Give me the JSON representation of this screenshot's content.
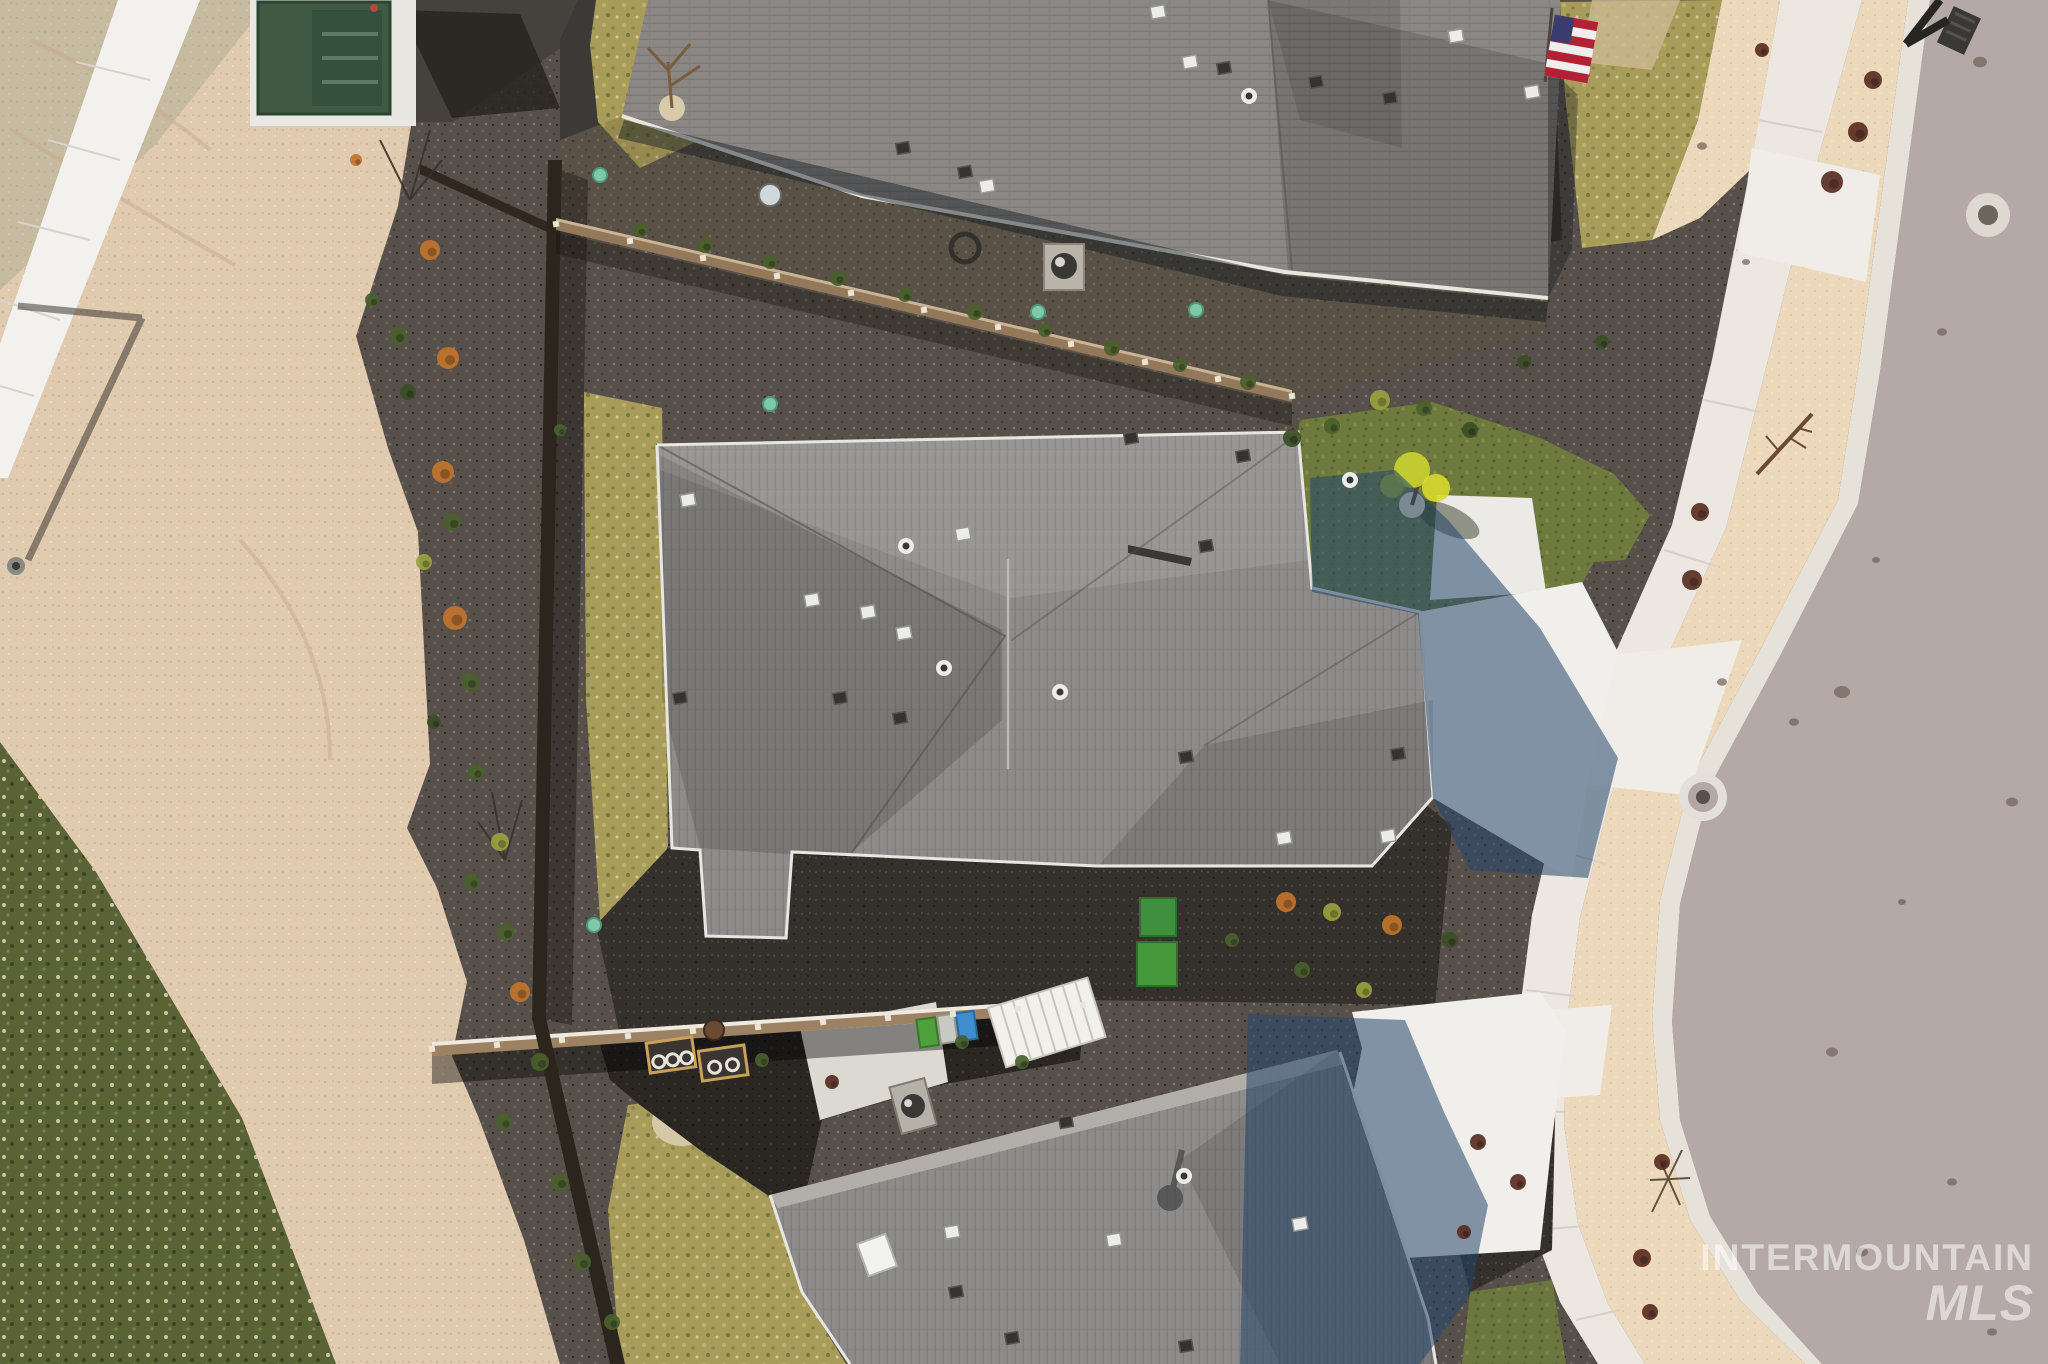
{
  "watermark": {
    "line1": "INTERMOUNTAIN",
    "line2": "MLS"
  },
  "palette": {
    "sand": "#e0cab0",
    "sandBright": "#ecd8ba",
    "road": "#b4a9a7",
    "curb": "#e6e1d9",
    "concrete": "#ece8e1",
    "concreteBright": "#f1efeb",
    "gravel": "#57504a",
    "gravelDark": "#34302b",
    "mulchDark": "#2a2723",
    "roofMid": "#8e8c8a",
    "roofTop": "#8a8784",
    "roofLight": "#b6b3ae",
    "drylawn": "#a89c5a",
    "greenlawn": "#6e7a3e",
    "weeds": "#5a6336",
    "fenceTan": "#93785a",
    "fenceDark": "#2c251e",
    "shadowBlue": "#24456b",
    "boxGreen": "#415a44",
    "binGreen": "#4da03c",
    "binBlue": "#3e8ed0",
    "binGray": "#c9c9c3",
    "flagRed": "#b22234",
    "flagBlue": "#3c3b6e",
    "teal": "#7fc9a8",
    "shrubOrange": "#c1742c",
    "shrubGreen": "#4a5f2d",
    "shrubYellow": "#97a33e",
    "shrubDark": "#3c4d26",
    "shrubRed": "#5a2e22",
    "white": "#f2f1ed"
  },
  "sprites": [
    {
      "k": "shrub",
      "x": 430,
      "y": 250,
      "r": 10,
      "c": "shrubOrange"
    },
    {
      "k": "shrub",
      "x": 398,
      "y": 336,
      "r": 9,
      "c": "shrubGreen"
    },
    {
      "k": "shrub",
      "x": 448,
      "y": 358,
      "r": 11,
      "c": "shrubOrange"
    },
    {
      "k": "shrub",
      "x": 372,
      "y": 300,
      "r": 7,
      "c": "shrubGreen"
    },
    {
      "k": "shrub",
      "x": 443,
      "y": 472,
      "r": 11,
      "c": "shrubOrange"
    },
    {
      "k": "shrub",
      "x": 408,
      "y": 392,
      "r": 8,
      "c": "shrubDark"
    },
    {
      "k": "shrub",
      "x": 452,
      "y": 522,
      "r": 9,
      "c": "shrubGreen"
    },
    {
      "k": "shrub",
      "x": 424,
      "y": 562,
      "r": 8,
      "c": "shrubYellow"
    },
    {
      "k": "shrub",
      "x": 455,
      "y": 618,
      "r": 12,
      "c": "shrubOrange"
    },
    {
      "k": "shrub",
      "x": 470,
      "y": 682,
      "r": 9,
      "c": "shrubGreen"
    },
    {
      "k": "shrub",
      "x": 434,
      "y": 722,
      "r": 7,
      "c": "shrubDark"
    },
    {
      "k": "shrub",
      "x": 476,
      "y": 772,
      "r": 8,
      "c": "shrubGreen"
    },
    {
      "k": "shrub",
      "x": 500,
      "y": 842,
      "r": 9,
      "c": "shrubYellow"
    },
    {
      "k": "shrub",
      "x": 472,
      "y": 882,
      "r": 8,
      "c": "shrubGreen"
    },
    {
      "k": "shrub",
      "x": 506,
      "y": 932,
      "r": 9,
      "c": "shrubGreen"
    },
    {
      "k": "shrub",
      "x": 520,
      "y": 992,
      "r": 10,
      "c": "shrubOrange"
    },
    {
      "k": "shrub",
      "x": 540,
      "y": 1062,
      "r": 9,
      "c": "shrubGreen"
    },
    {
      "k": "shrub",
      "x": 504,
      "y": 1122,
      "r": 8,
      "c": "shrubGreen"
    },
    {
      "k": "shrub",
      "x": 560,
      "y": 1182,
      "r": 9,
      "c": "shrubGreen"
    },
    {
      "k": "shrub",
      "x": 582,
      "y": 1262,
      "r": 9,
      "c": "shrubGreen"
    },
    {
      "k": "shrub",
      "x": 612,
      "y": 1322,
      "r": 8,
      "c": "shrubGreen"
    },
    {
      "k": "shrub",
      "x": 356,
      "y": 160,
      "r": 6,
      "c": "shrubOrange"
    },
    {
      "k": "shrub",
      "x": 640,
      "y": 230,
      "r": 7,
      "c": "shrubGreen"
    },
    {
      "k": "shrub",
      "x": 705,
      "y": 245,
      "r": 8,
      "c": "shrubGreen"
    },
    {
      "k": "shrub",
      "x": 770,
      "y": 262,
      "r": 7,
      "c": "shrubGreen"
    },
    {
      "k": "shrub",
      "x": 838,
      "y": 278,
      "r": 8,
      "c": "shrubGreen"
    },
    {
      "k": "shrub",
      "x": 905,
      "y": 295,
      "r": 7,
      "c": "shrubGreen"
    },
    {
      "k": "shrub",
      "x": 975,
      "y": 312,
      "r": 8,
      "c": "shrubGreen"
    },
    {
      "k": "shrub",
      "x": 1045,
      "y": 330,
      "r": 7,
      "c": "shrubGreen"
    },
    {
      "k": "shrub",
      "x": 1112,
      "y": 348,
      "r": 8,
      "c": "shrubGreen"
    },
    {
      "k": "shrub",
      "x": 1180,
      "y": 365,
      "r": 7,
      "c": "shrubGreen"
    },
    {
      "k": "shrub",
      "x": 1248,
      "y": 382,
      "r": 8,
      "c": "shrubGreen"
    },
    {
      "k": "shrub",
      "x": 1292,
      "y": 438,
      "r": 9,
      "c": "shrubDark"
    },
    {
      "k": "shrub",
      "x": 1332,
      "y": 426,
      "r": 8,
      "c": "shrubGreen"
    },
    {
      "k": "shrub",
      "x": 1380,
      "y": 400,
      "r": 10,
      "c": "shrubYellow"
    },
    {
      "k": "shrub",
      "x": 1424,
      "y": 408,
      "r": 8,
      "c": "shrubGreen"
    },
    {
      "k": "shrub",
      "x": 1470,
      "y": 430,
      "r": 8,
      "c": "shrubDark"
    },
    {
      "k": "shrub",
      "x": 1524,
      "y": 362,
      "r": 7,
      "c": "shrubDark"
    },
    {
      "k": "shrub",
      "x": 1602,
      "y": 342,
      "r": 7,
      "c": "shrubDark"
    },
    {
      "k": "shrub",
      "x": 1286,
      "y": 902,
      "r": 10,
      "c": "shrubOrange"
    },
    {
      "k": "shrub",
      "x": 1332,
      "y": 912,
      "r": 9,
      "c": "shrubYellow"
    },
    {
      "k": "shrub",
      "x": 1392,
      "y": 925,
      "r": 10,
      "c": "shrubOrange"
    },
    {
      "k": "shrub",
      "x": 1450,
      "y": 940,
      "r": 8,
      "c": "shrubDark"
    },
    {
      "k": "shrub",
      "x": 1232,
      "y": 940,
      "r": 7,
      "c": "shrubGreen"
    },
    {
      "k": "shrub",
      "x": 1302,
      "y": 970,
      "r": 8,
      "c": "shrubGreen"
    },
    {
      "k": "shrub",
      "x": 1364,
      "y": 990,
      "r": 8,
      "c": "shrubYellow"
    },
    {
      "k": "shrub",
      "x": 1873,
      "y": 80,
      "r": 9,
      "c": "shrubRed"
    },
    {
      "k": "shrub",
      "x": 1858,
      "y": 132,
      "r": 10,
      "c": "shrubRed"
    },
    {
      "k": "shrub",
      "x": 1832,
      "y": 182,
      "r": 11,
      "c": "shrubRed"
    },
    {
      "k": "shrub",
      "x": 1700,
      "y": 512,
      "r": 9,
      "c": "shrubRed"
    },
    {
      "k": "shrub",
      "x": 1692,
      "y": 580,
      "r": 10,
      "c": "shrubRed"
    },
    {
      "k": "shrub",
      "x": 1662,
      "y": 1162,
      "r": 8,
      "c": "shrubRed"
    },
    {
      "k": "shrub",
      "x": 1642,
      "y": 1258,
      "r": 9,
      "c": "shrubRed"
    },
    {
      "k": "shrub",
      "x": 1650,
      "y": 1312,
      "r": 8,
      "c": "shrubRed"
    },
    {
      "k": "shrub",
      "x": 1762,
      "y": 50,
      "r": 7,
      "c": "shrubRed"
    },
    {
      "k": "shrub",
      "x": 762,
      "y": 1060,
      "r": 7,
      "c": "shrubGreen"
    },
    {
      "k": "shrub",
      "x": 832,
      "y": 1082,
      "r": 7,
      "c": "shrubRed"
    },
    {
      "k": "shrub",
      "x": 962,
      "y": 1042,
      "r": 7,
      "c": "shrubGreen"
    },
    {
      "k": "shrub",
      "x": 1022,
      "y": 1062,
      "r": 7,
      "c": "shrubGreen"
    },
    {
      "k": "shrub",
      "x": 560,
      "y": 430,
      "r": 6,
      "c": "shrubGreen"
    },
    {
      "k": "shrub",
      "x": 1478,
      "y": 1142,
      "r": 8,
      "c": "shrubRed"
    },
    {
      "k": "shrub",
      "x": 1518,
      "y": 1182,
      "r": 8,
      "c": "shrubRed"
    },
    {
      "k": "shrub",
      "x": 1464,
      "y": 1232,
      "r": 7,
      "c": "shrubRed"
    },
    {
      "k": "vent",
      "t": "l",
      "x": 1158,
      "y": 12
    },
    {
      "k": "vent",
      "t": "l",
      "x": 1190,
      "y": 62
    },
    {
      "k": "vent",
      "t": "d",
      "x": 1224,
      "y": 68
    },
    {
      "k": "vent",
      "t": "p",
      "x": 1249,
      "y": 96
    },
    {
      "k": "vent",
      "t": "d",
      "x": 1316,
      "y": 82
    },
    {
      "k": "vent",
      "t": "d",
      "x": 1390,
      "y": 98
    },
    {
      "k": "vent",
      "t": "d",
      "x": 965,
      "y": 172
    },
    {
      "k": "vent",
      "t": "l",
      "x": 1456,
      "y": 36
    },
    {
      "k": "vent",
      "t": "l",
      "x": 1532,
      "y": 92
    },
    {
      "k": "vent",
      "t": "l",
      "x": 987,
      "y": 186
    },
    {
      "k": "vent",
      "t": "d",
      "x": 903,
      "y": 148
    },
    {
      "k": "vent",
      "t": "l",
      "x": 688,
      "y": 500
    },
    {
      "k": "vent",
      "t": "d",
      "x": 680,
      "y": 698
    },
    {
      "k": "vent",
      "t": "l",
      "x": 812,
      "y": 600
    },
    {
      "k": "vent",
      "t": "l",
      "x": 868,
      "y": 612
    },
    {
      "k": "vent",
      "t": "p",
      "x": 906,
      "y": 546
    },
    {
      "k": "vent",
      "t": "l",
      "x": 963,
      "y": 534
    },
    {
      "k": "vent",
      "t": "l",
      "x": 904,
      "y": 633
    },
    {
      "k": "vent",
      "t": "d",
      "x": 840,
      "y": 698
    },
    {
      "k": "vent",
      "t": "d",
      "x": 900,
      "y": 718
    },
    {
      "k": "vent",
      "t": "p",
      "x": 944,
      "y": 668
    },
    {
      "k": "vent",
      "t": "d",
      "x": 1243,
      "y": 456
    },
    {
      "k": "vent",
      "t": "d",
      "x": 1131,
      "y": 438
    },
    {
      "k": "vent",
      "t": "p",
      "x": 1060,
      "y": 692
    },
    {
      "k": "vent",
      "t": "d",
      "x": 1186,
      "y": 757
    },
    {
      "k": "vent",
      "t": "d",
      "x": 1398,
      "y": 754
    },
    {
      "k": "vent",
      "t": "l",
      "x": 1284,
      "y": 838
    },
    {
      "k": "vent",
      "t": "l",
      "x": 1388,
      "y": 836
    },
    {
      "k": "vent",
      "t": "d",
      "x": 1206,
      "y": 546
    },
    {
      "k": "vent",
      "t": "p",
      "x": 1350,
      "y": 480
    },
    {
      "k": "vent",
      "t": "d",
      "x": 1066,
      "y": 1122
    },
    {
      "k": "vent",
      "t": "p",
      "x": 1184,
      "y": 1176
    },
    {
      "k": "vent",
      "t": "l",
      "x": 1114,
      "y": 1240
    },
    {
      "k": "vent",
      "t": "d",
      "x": 1186,
      "y": 1346
    },
    {
      "k": "vent",
      "t": "d",
      "x": 956,
      "y": 1292
    },
    {
      "k": "vent",
      "t": "d",
      "x": 1012,
      "y": 1338
    },
    {
      "k": "vent",
      "t": "l",
      "x": 1300,
      "y": 1224
    },
    {
      "k": "vent",
      "t": "l",
      "x": 952,
      "y": 1232
    },
    {
      "k": "dirt",
      "x": 1980,
      "y": 62,
      "r": 7
    },
    {
      "k": "dirt",
      "x": 1942,
      "y": 332,
      "r": 5
    },
    {
      "k": "dirt",
      "x": 1842,
      "y": 692,
      "r": 8
    },
    {
      "k": "dirt",
      "x": 1794,
      "y": 722,
      "r": 5
    },
    {
      "k": "dirt",
      "x": 1832,
      "y": 1052,
      "r": 6
    },
    {
      "k": "dirt",
      "x": 1952,
      "y": 1182,
      "r": 5
    },
    {
      "k": "dirt",
      "x": 1702,
      "y": 146,
      "r": 5
    },
    {
      "k": "dirt",
      "x": 1746,
      "y": 262,
      "r": 4
    },
    {
      "k": "dirt",
      "x": 2012,
      "y": 802,
      "r": 6
    },
    {
      "k": "dirt",
      "x": 1902,
      "y": 902,
      "r": 4
    },
    {
      "k": "dirt",
      "x": 1862,
      "y": 1252,
      "r": 6
    },
    {
      "k": "dirt",
      "x": 1992,
      "y": 1332,
      "r": 5
    },
    {
      "k": "dirt",
      "x": 1722,
      "y": 682,
      "r": 5
    },
    {
      "k": "dirt",
      "x": 1876,
      "y": 560,
      "r": 4
    },
    {
      "k": "post",
      "x": 556,
      "y": 224
    },
    {
      "k": "post",
      "x": 630,
      "y": 241
    },
    {
      "k": "post",
      "x": 703,
      "y": 258
    },
    {
      "k": "post",
      "x": 777,
      "y": 276
    },
    {
      "k": "post",
      "x": 851,
      "y": 293
    },
    {
      "k": "post",
      "x": 924,
      "y": 310
    },
    {
      "k": "post",
      "x": 998,
      "y": 327
    },
    {
      "k": "post",
      "x": 1071,
      "y": 344
    },
    {
      "k": "post",
      "x": 1145,
      "y": 362
    },
    {
      "k": "post",
      "x": 1218,
      "y": 379
    },
    {
      "k": "post",
      "x": 1292,
      "y": 396
    },
    {
      "k": "post",
      "x": 432,
      "y": 1049
    },
    {
      "k": "post",
      "x": 497,
      "y": 1045
    },
    {
      "k": "post",
      "x": 562,
      "y": 1040
    },
    {
      "k": "post",
      "x": 628,
      "y": 1036
    },
    {
      "k": "post",
      "x": 693,
      "y": 1031
    },
    {
      "k": "post",
      "x": 758,
      "y": 1027
    },
    {
      "k": "post",
      "x": 823,
      "y": 1022
    },
    {
      "k": "post",
      "x": 888,
      "y": 1018
    },
    {
      "k": "post",
      "x": 953,
      "y": 1014
    },
    {
      "k": "post",
      "x": 1018,
      "y": 1009
    },
    {
      "k": "post",
      "x": 1083,
      "y": 1005
    },
    {
      "k": "marker",
      "x": 600,
      "y": 175
    },
    {
      "k": "marker",
      "x": 770,
      "y": 404
    },
    {
      "k": "marker",
      "x": 1038,
      "y": 312
    },
    {
      "k": "marker",
      "x": 1196,
      "y": 310
    },
    {
      "k": "marker",
      "x": 594,
      "y": 925
    }
  ]
}
